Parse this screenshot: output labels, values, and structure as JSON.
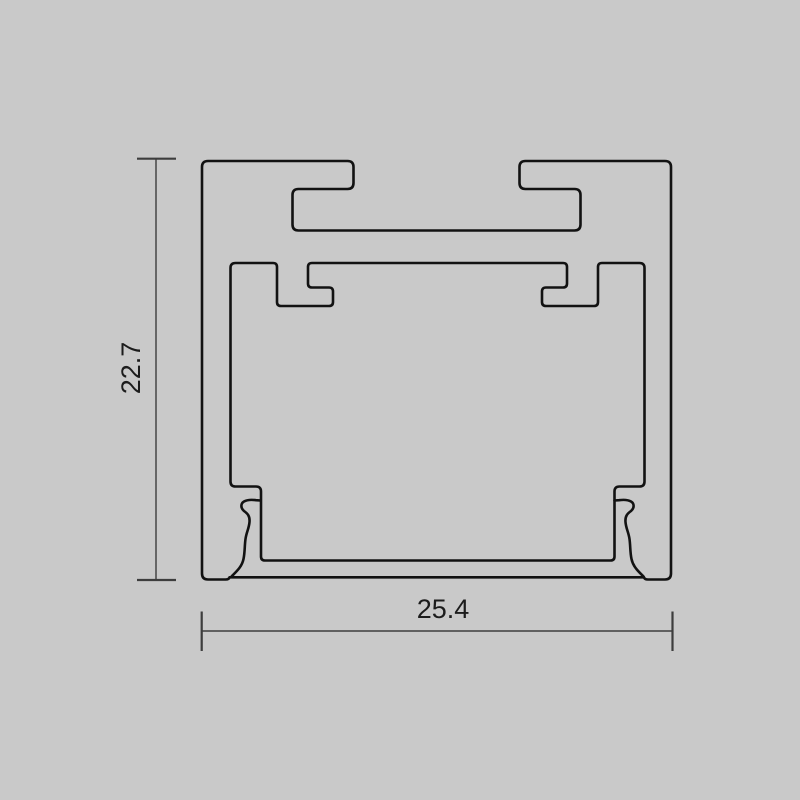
{
  "page": {
    "background_color": "#c9c9c9",
    "description": "Technical dimension drawing of an aluminium LED strip profile cross-section"
  },
  "colors": {
    "profile_line": "#121212",
    "dimension_line": "#3d3d3d",
    "dimension_text": "#1c1c1c"
  },
  "dimensions": {
    "height": {
      "label": "22.7"
    },
    "width": {
      "label": "25.4"
    }
  }
}
